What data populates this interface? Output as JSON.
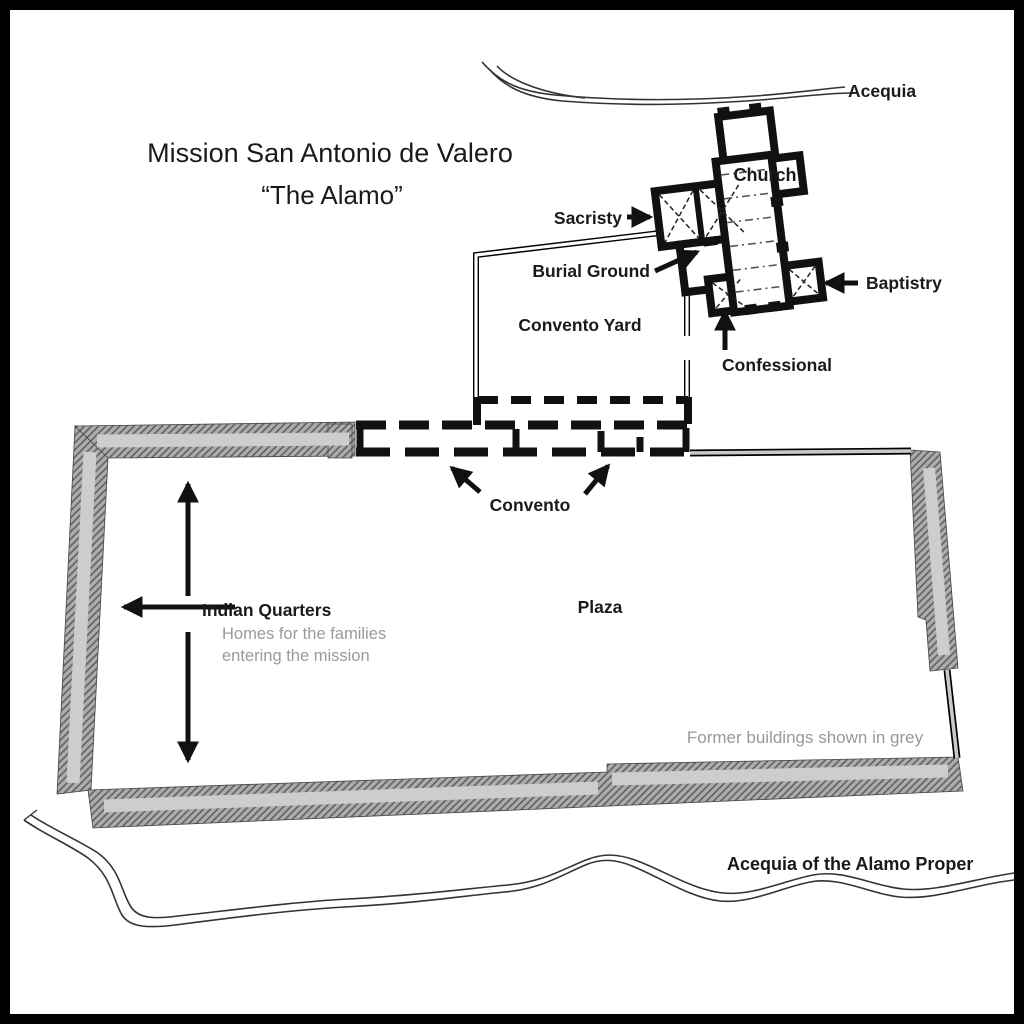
{
  "map": {
    "title": "Mission San Antonio de Valero",
    "subtitle": "“The Alamo”",
    "labels": {
      "acequia_north": "Acequia",
      "church": "Church",
      "sacristy": "Sacristy",
      "burial_ground": "Burial Ground",
      "baptistry": "Baptistry",
      "confessional": "Confessional",
      "convento_yard": "Convento Yard",
      "convento": "Convento",
      "indian_quarters": "Indian Quarters",
      "indian_quarters_desc_line1": "Homes for the families",
      "indian_quarters_desc_line2": "entering the mission",
      "plaza": "Plaza",
      "legend_note": "Former buildings shown in grey",
      "acequia_south": "Acequia of the Alamo Proper"
    },
    "colors": {
      "ink": "#111111",
      "grey_text": "#999999",
      "former_wall_hatch": "#adadad",
      "former_wall_stripe": "#cdcdcd",
      "thin_wall_fill": "#c9c9c9"
    }
  }
}
